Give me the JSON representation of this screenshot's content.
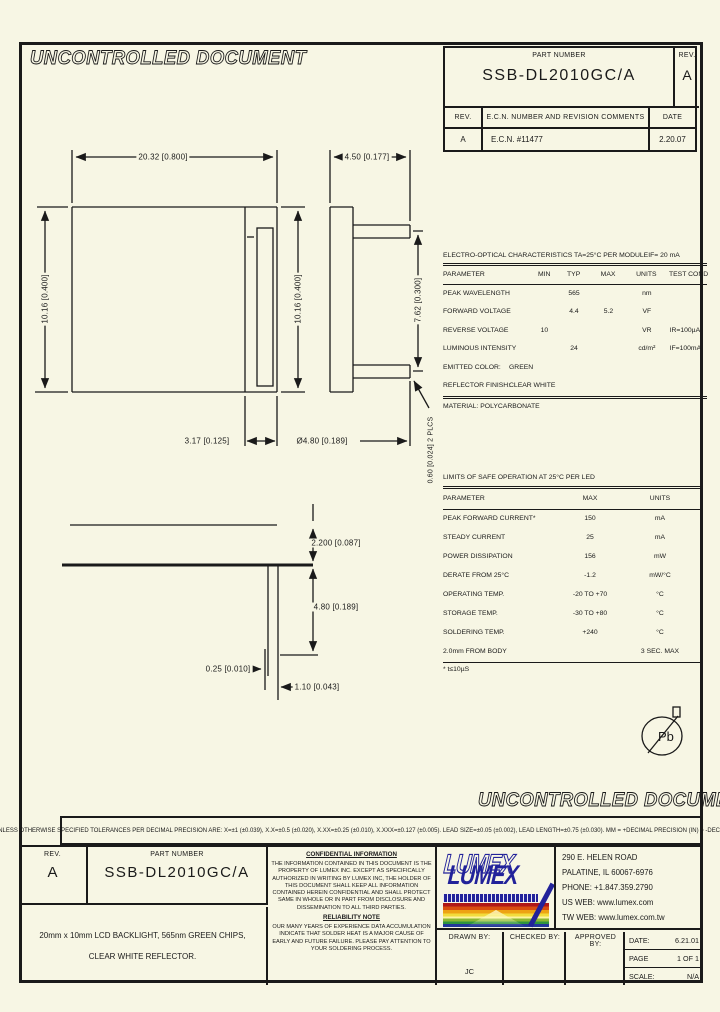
{
  "sheet": {
    "watermark_top": "UNCONTROLLED DOCUMENT",
    "watermark_bottom": "UNCONTROLLED DOCUMENT"
  },
  "rev_block": {
    "part_number_label": "PART NUMBER",
    "part_number": "SSB-DL2010GC/A",
    "rev_label": "REV.",
    "rev_value": "A",
    "history_headers": [
      "REV.",
      "E.C.N. NUMBER AND REVISION COMMENTS",
      "DATE"
    ],
    "history_rows": [
      [
        "A",
        "E.C.N. #11477",
        "2.20.07"
      ]
    ]
  },
  "drawing": {
    "dim_overall_width": "20.32 [0.800]",
    "dim_tab_width": "4.50 [0.177]",
    "dim_height_left": "10.16 [0.400]",
    "dim_height_mid": "10.16 [0.400]",
    "dim_pin_spacing": "7.62 [0.300]",
    "dim_pin_thickness": "0.60 [0.024] 2 PLCS",
    "dim_slot_width": "3.17 [0.125]",
    "dim_pin_length_top": "Ø4.80 [0.189]",
    "dim_body_thickness": "2.200 [0.087]",
    "dim_pin_length_side": "4.80 [0.189]",
    "dim_pin_offset": "0.25 [0.010]",
    "dim_pin_width": "1.10 [0.043]",
    "pb_free_label": "Pb"
  },
  "eo_table": {
    "title": "ELECTRO-OPTICAL CHARACTERISTICS TA=25°C PER MODULE",
    "title_condition": "IF= 20 mA",
    "headers": [
      "PARAMETER",
      "MIN",
      "TYP",
      "MAX",
      "UNITS",
      "TEST COND"
    ],
    "rows": [
      {
        "param": "PEAK WAVELENGTH",
        "min": "",
        "typ": "565",
        "max": "",
        "units": "nm",
        "test": ""
      },
      {
        "param": "FORWARD VOLTAGE",
        "min": "",
        "typ": "4.4",
        "max": "5.2",
        "units": "VF",
        "test": ""
      },
      {
        "param": "REVERSE VOLTAGE",
        "min": "10",
        "typ": "",
        "max": "",
        "units": "VR",
        "test": "IR=100µA"
      },
      {
        "param": "LUMINOUS INTENSITY",
        "min": "",
        "typ": "24",
        "max": "",
        "units": "cd/m²",
        "test": "IF=100mA"
      }
    ],
    "color_row": {
      "label": "EMITTED COLOR:",
      "value": "GREEN"
    },
    "finish_row": {
      "label": "REFLECTOR FINISH:",
      "value": "CLEAR WHITE"
    },
    "material_note": "MATERIAL: POLYCARBONATE"
  },
  "safe_table": {
    "title": "LIMITS OF SAFE OPERATION AT 25°C   PER LED",
    "headers": [
      "PARAMETER",
      "MAX",
      "UNITS"
    ],
    "rows": [
      {
        "param": "PEAK FORWARD CURRENT*",
        "max": "150",
        "units": "mA"
      },
      {
        "param": "STEADY CURRENT",
        "max": "25",
        "units": "mA"
      },
      {
        "param": "POWER DISSIPATION",
        "max": "156",
        "units": "mW"
      },
      {
        "param": "DERATE FROM 25°C",
        "max": "-1.2",
        "units": "mW/°C"
      },
      {
        "param": "OPERATING TEMP.",
        "max": "-20 TO +70",
        "units": "°C"
      },
      {
        "param": "STORAGE TEMP.",
        "max": "-30 TO +80",
        "units": "°C"
      },
      {
        "param": "SOLDERING TEMP.",
        "max": "+240",
        "units": "°C"
      },
      {
        "param": "2.0mm FROM BODY",
        "max": "",
        "units": "3 SEC. MAX"
      }
    ],
    "footnote": "* t≤10µS"
  },
  "tolerance_note": "UNLESS OTHERWISE SPECIFIED TOLERANCES PER DECIMAL PRECISION ARE: X=±1 (±0.039), X.X=±0.5 (±0.020), X.XX=±0.25 (±0.010), X.XXX=±0.127 (±0.005).  LEAD SIZE=±0.05 (±0.002), LEAD LENGTH=±0.75 (±0.030).  MM = +DECIMAL PRECISION   (IN) = -DECIMAL PRECISION",
  "title_block": {
    "rev_label": "REV.",
    "rev_value": "A",
    "part_number_label": "PART NUMBER",
    "part_number": "SSB-DL2010GC/A",
    "description_line1": "20mm x 10mm LCD BACKLIGHT, 565nm GREEN CHIPS,",
    "description_line2": "CLEAR WHITE REFLECTOR.",
    "confidential_title": "CONFIDENTIAL INFORMATION",
    "confidential_text": "THE INFORMATION CONTAINED IN THIS DOCUMENT IS THE PROPERTY OF LUMEX INC. EXCEPT AS SPECIFICALLY AUTHORIZED IN WRITING BY LUMEX INC, THE HOLDER OF THIS DOCUMENT SHALL KEEP ALL INFORMATION CONTAINED HEREIN CONFIDENTIAL AND SHALL PROTECT SAME IN WHOLE OR IN PART FROM DISCLOSURE AND DISSEMINATION TO ALL THIRD PARTIES.",
    "reliability_title": "RELIABILITY NOTE",
    "reliability_text": "OUR MANY YEARS OF EXPERIENCE DATA ACCUMULATION INDICATE THAT SOLDER HEAT IS A MAJOR CAUSE OF EARLY AND FUTURE FAILURE. PLEASE PAY ATTENTION TO YOUR SOLDERING PROCESS.",
    "logo_text": "LUMEX",
    "address_lines": [
      "290 E. HELEN ROAD",
      "PALATINE, IL   60067-6976",
      "PHONE: +1.847.359.2790",
      "US WEB: www.lumex.com",
      "TW WEB: www.lumex.com.tw"
    ],
    "drawn_by_label": "DRAWN BY:",
    "drawn_by_value": "JC",
    "checked_by_label": "CHECKED BY:",
    "approved_by_label": "APPROVED BY:",
    "date_label": "DATE:",
    "date_value": "6.21.01",
    "page_label": "PAGE",
    "page_value": "1 OF 1",
    "scale_label": "SCALE:",
    "scale_value": "N/A"
  }
}
